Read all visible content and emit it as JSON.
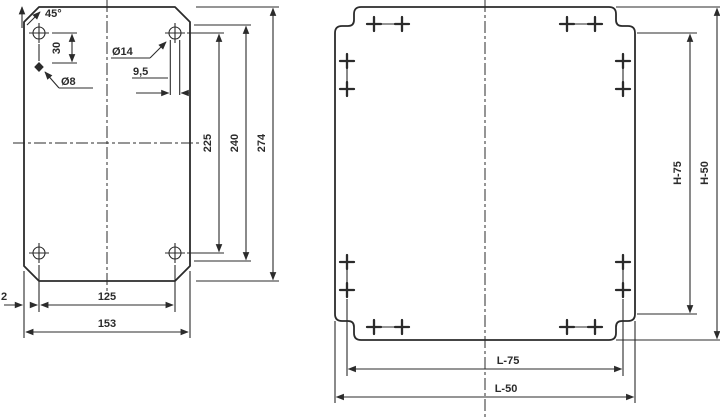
{
  "left_plate": {
    "chamfer_angle": "45°",
    "hole_offset": "30",
    "pilot_hole_diameter": "Ø8",
    "corner_hole_diameter": "Ø14",
    "slot_width": "9,5",
    "hole_spacing_vertical": "225",
    "inner_height": "240",
    "overall_height": "274",
    "bottom_flat_width": "125",
    "overall_width": "153",
    "edge_offset": "2"
  },
  "right_plate": {
    "vertical_dim_inner": "H-75",
    "vertical_dim_outer": "H-50",
    "horizontal_dim_inner": "L-75",
    "horizontal_dim_outer": "L-50"
  },
  "colors": {
    "line": "#2b2b2b",
    "background": "#ffffff"
  }
}
